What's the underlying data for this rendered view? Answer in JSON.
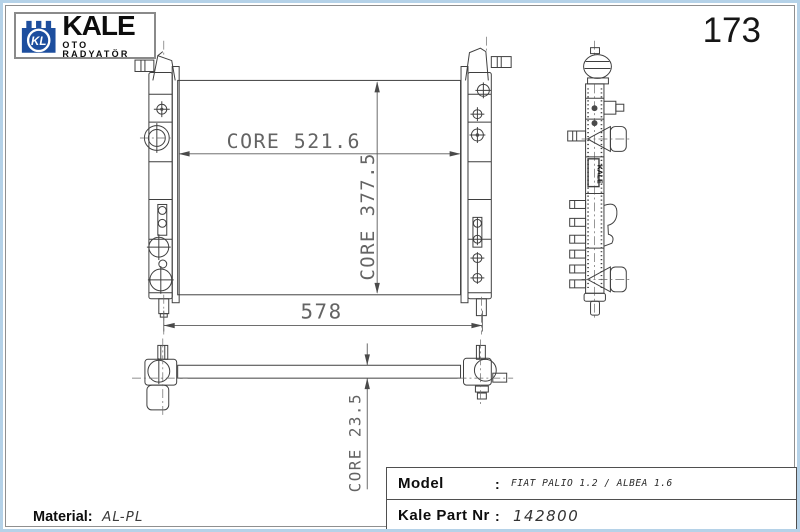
{
  "page": {
    "number": "173"
  },
  "logo": {
    "monogram": "KL",
    "brand": "KALE",
    "subtitle": "OTO RADYATÖR"
  },
  "drawing": {
    "dim_core_width": "CORE 521.6",
    "dim_core_height": "CORE 377.5",
    "dim_overall_width": "578",
    "dim_core_depth": "CORE 23.5",
    "side_tank_label": "KALE"
  },
  "footer": {
    "material_label": "Material:",
    "material_value": "AL-PL"
  },
  "spec_table": {
    "rows": [
      {
        "label": "Model",
        "colon": ":",
        "value": "FIAT PALIO 1.2 / ALBEA 1.6"
      },
      {
        "label": "Kale Part Nr",
        "colon": ":",
        "value": "142800"
      }
    ]
  }
}
